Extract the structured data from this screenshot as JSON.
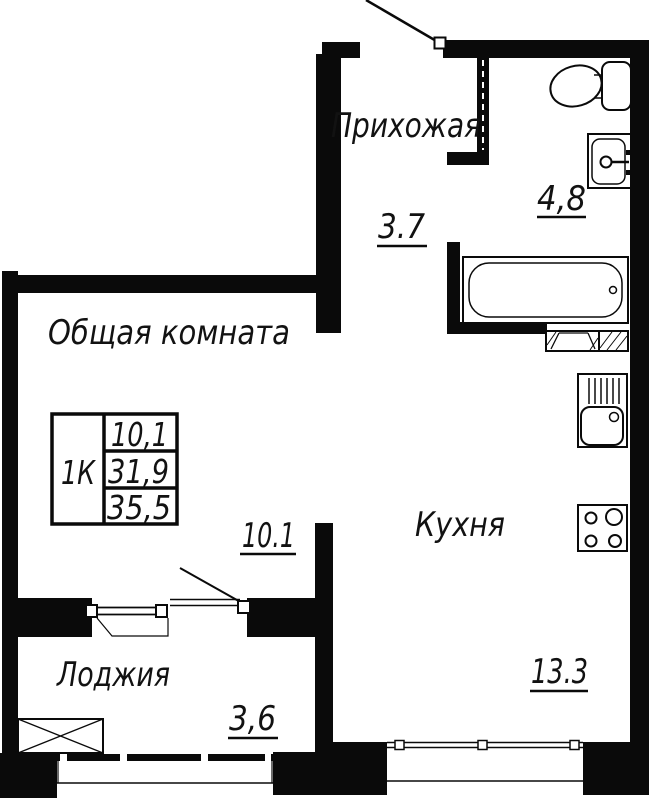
{
  "plan": {
    "rooms": {
      "hallway": {
        "name": "Прихожая",
        "area": "3.7"
      },
      "living_room": {
        "name": "Общая комната",
        "area": "10.1"
      },
      "kitchen": {
        "name": "Кухня",
        "area": "13.3"
      },
      "bathroom": {
        "area": "4,8"
      },
      "loggia": {
        "name": "Лоджия",
        "area": "3,6"
      }
    },
    "info_table": {
      "unit_type": "1К",
      "living_area": "10,1",
      "total_area": "31,9",
      "overall_area": "35,5"
    },
    "colors": {
      "wall": "#0a0a0a",
      "background": "#ffffff",
      "text": "#121212"
    }
  }
}
